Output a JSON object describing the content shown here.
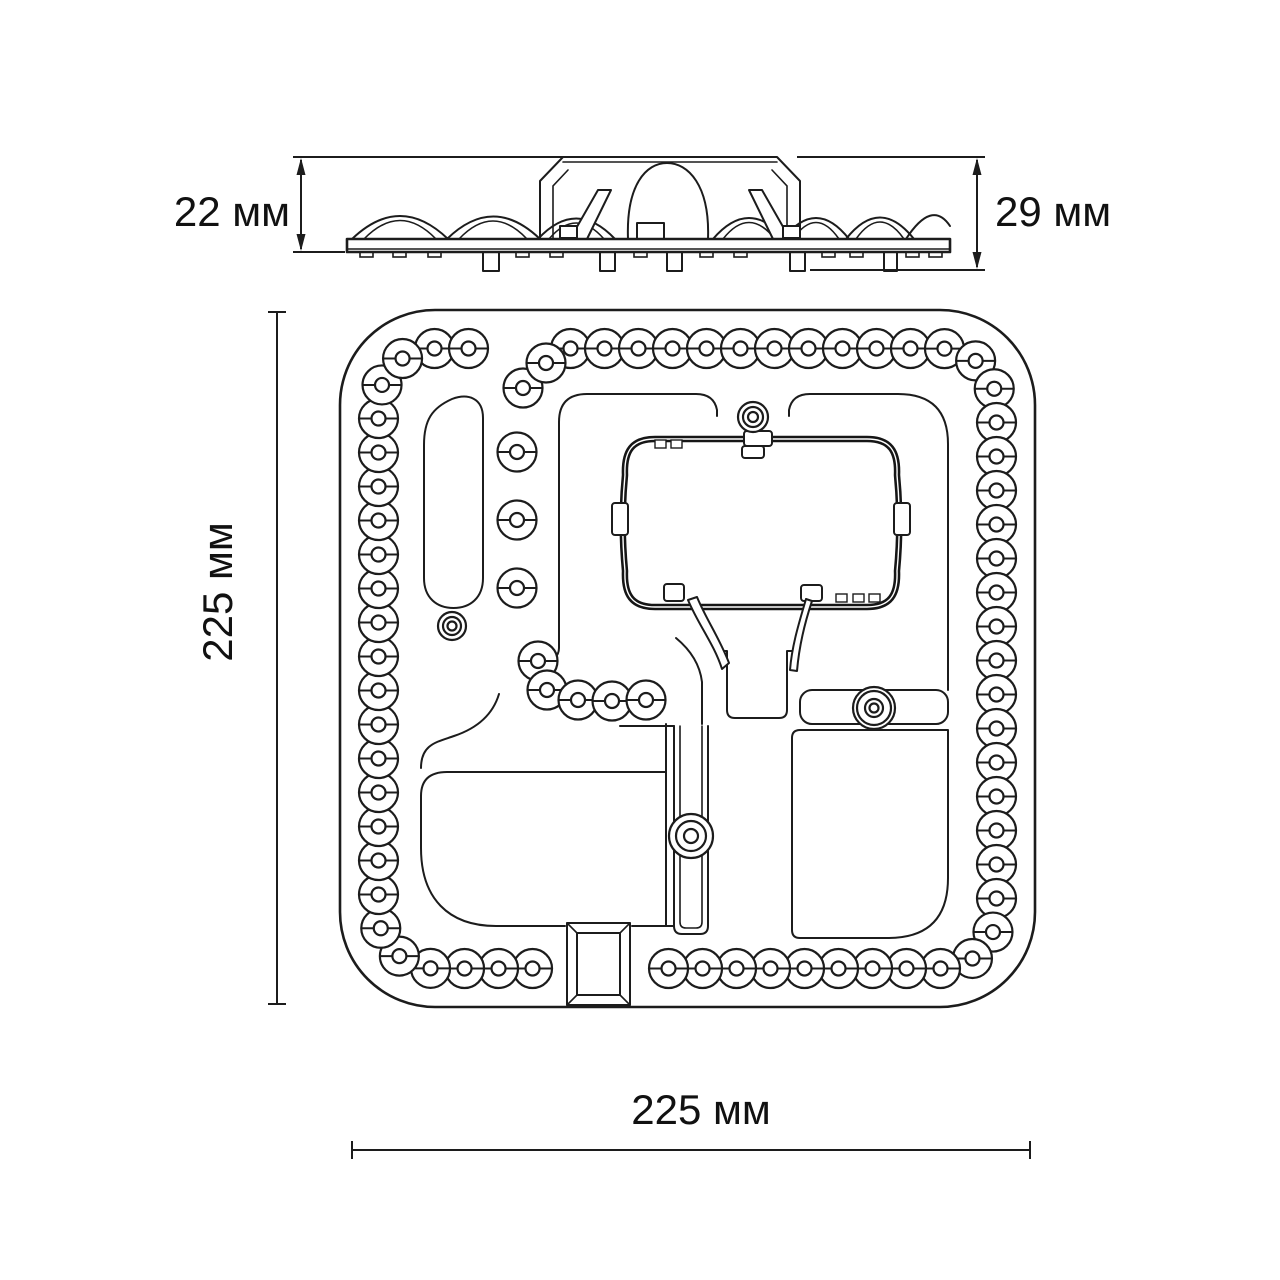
{
  "page": {
    "background": "#ffffff",
    "line_color": "#1c1c1c",
    "text_color": "#111111"
  },
  "dimensions": {
    "side_height_left": "22 мм",
    "side_height_right": "29 мм",
    "top_height": "225 мм",
    "top_width": "225 мм"
  },
  "drawing": {
    "description": "LED ceiling light module, side view and top view with dimensions",
    "led_ring": {
      "rect": {
        "x": 378.5,
        "y": 348.5,
        "w": 618,
        "h": 620,
        "corner_r": 56
      },
      "spacing": 34,
      "outer_r": 19.5,
      "inner_r": 7,
      "skip_top_x": [
        483,
        563
      ],
      "skip_bottom_x": [
        547,
        651
      ]
    },
    "led_singles": [
      [
        517,
        452
      ],
      [
        517,
        520
      ],
      [
        517,
        588
      ],
      [
        523,
        388
      ],
      [
        546,
        363
      ],
      [
        538,
        661
      ],
      [
        547,
        690
      ],
      [
        578,
        700
      ],
      [
        612,
        701
      ],
      [
        646,
        700
      ]
    ],
    "mount_holes": [
      {
        "x": 753,
        "y": 417,
        "radii": [
          15,
          10,
          5
        ]
      },
      {
        "x": 452,
        "y": 626,
        "radii": [
          14,
          9,
          4.5
        ]
      },
      {
        "x": 874,
        "y": 708,
        "radii": [
          21,
          17,
          9,
          4.5
        ]
      },
      {
        "x": 691,
        "y": 836,
        "radii": [
          22,
          15,
          7
        ]
      }
    ]
  }
}
